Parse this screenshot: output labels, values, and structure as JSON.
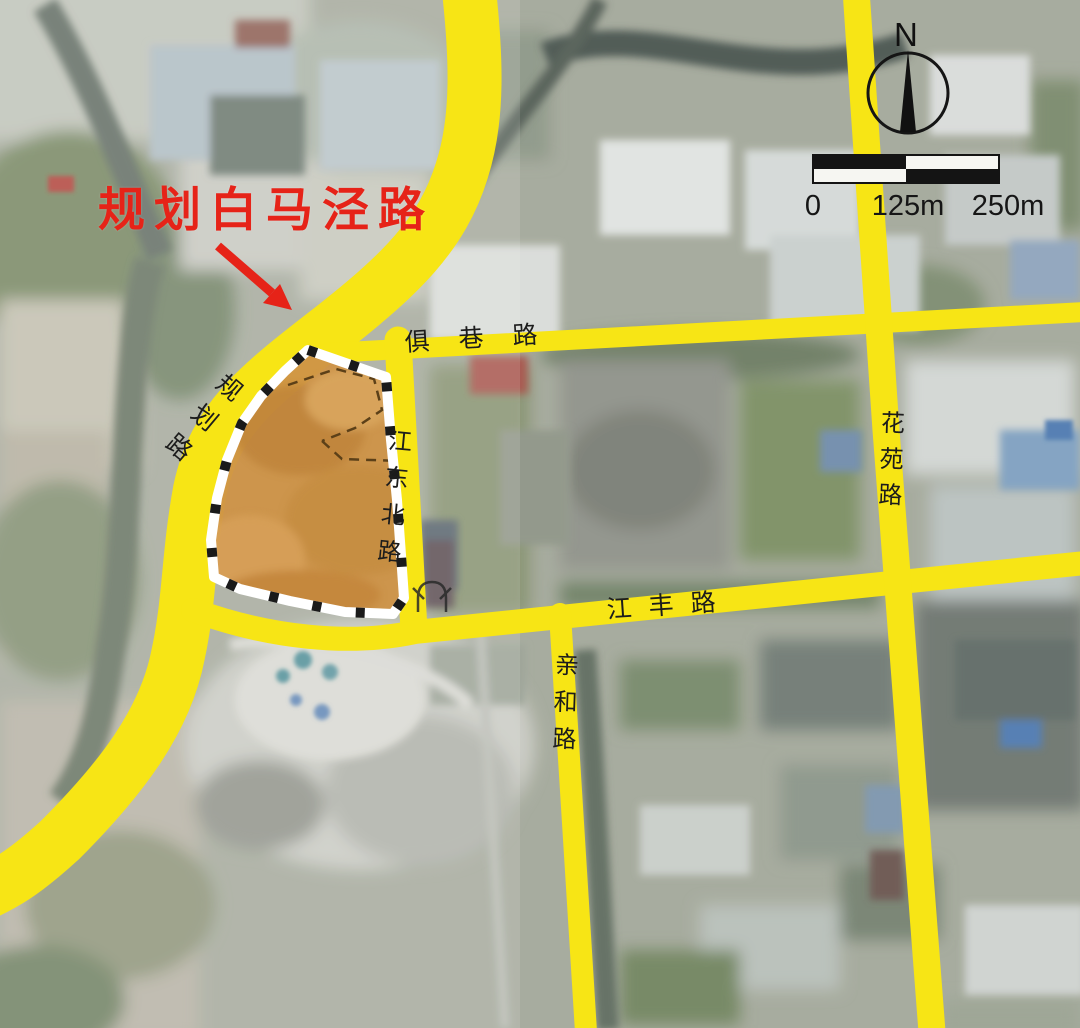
{
  "annotation": {
    "label": "规划白马泾路",
    "color": "#e62318"
  },
  "roads": {
    "planned_road": "规划路",
    "juxiang_road": "俱巷路",
    "jiangdongbei_road": "江东北路",
    "huayuan_road": "花苑路",
    "jiangfeng_road": "江丰路",
    "qinhe_road": "亲和路"
  },
  "compass": {
    "north_label": "N"
  },
  "scale_bar": {
    "labels": [
      "0",
      "125m",
      "250m"
    ]
  },
  "legend_colors": {
    "road_highlight": "#f7e515",
    "parcel_highlight": "#cf9347",
    "parcel_boundary": "#ffffff",
    "annotation_red": "#e62318"
  }
}
